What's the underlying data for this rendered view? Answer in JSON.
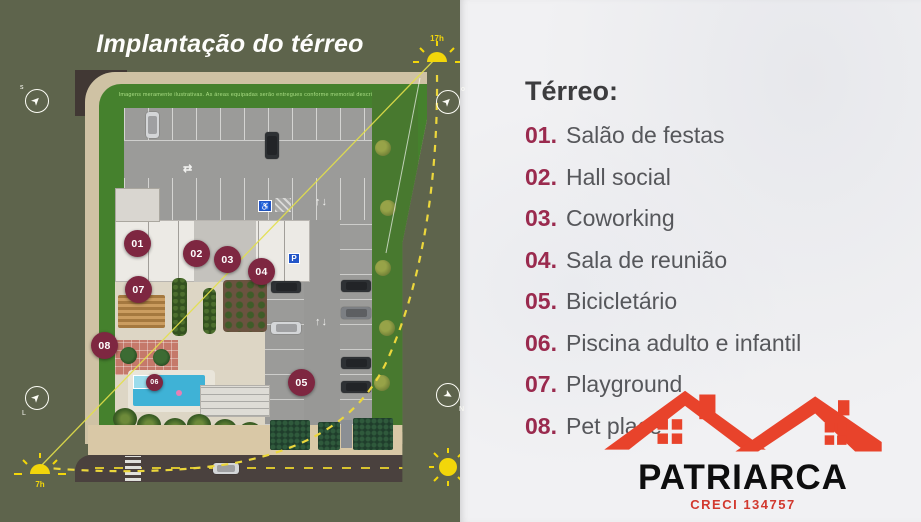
{
  "left_panel": {
    "title": "Implantação do térreo",
    "disclaimer": "Imagens meramente ilustrativas. As áreas equipadas serão entregues conforme memorial descritivo.",
    "markers": [
      {
        "num": "01"
      },
      {
        "num": "02"
      },
      {
        "num": "03"
      },
      {
        "num": "04"
      },
      {
        "num": "05"
      },
      {
        "num": "06"
      },
      {
        "num": "07"
      },
      {
        "num": "08"
      }
    ],
    "suns": {
      "morning_label": "7h",
      "evening_label": "17h"
    },
    "compass_letters": {
      "top_left": "s",
      "top_right": "o",
      "bottom_left": "L",
      "bottom_right": "N"
    }
  },
  "icons": {
    "wheelchair": "♿",
    "parking": "P",
    "lane_updown": "↑↓",
    "lane_twoway": "⇄"
  },
  "right_panel": {
    "heading": "Térreo:",
    "items": [
      {
        "num": "01.",
        "label": "Salão de festas"
      },
      {
        "num": "02.",
        "label": "Hall social"
      },
      {
        "num": "03.",
        "label": "Coworking"
      },
      {
        "num": "04.",
        "label": "Sala de reunião"
      },
      {
        "num": "05.",
        "label": "Bicicletário"
      },
      {
        "num": "06.",
        "label": "Piscina adulto e infantil"
      },
      {
        "num": "07.",
        "label": "Playground"
      },
      {
        "num": "08.",
        "label": "Pet place"
      }
    ],
    "logo": {
      "name": "PATRIARCA",
      "creci": "CRECI 134757"
    }
  },
  "colors": {
    "background_olive": "#5e644c",
    "panel_light": "#f1f1f3",
    "marker_maroon": "#7e2741",
    "list_number_maroon": "#9a2a4e",
    "logo_red": "#e8432b",
    "sun_yellow": "#f2d60a",
    "lawn_green": "#45812d",
    "border_red": "#9e2027"
  }
}
